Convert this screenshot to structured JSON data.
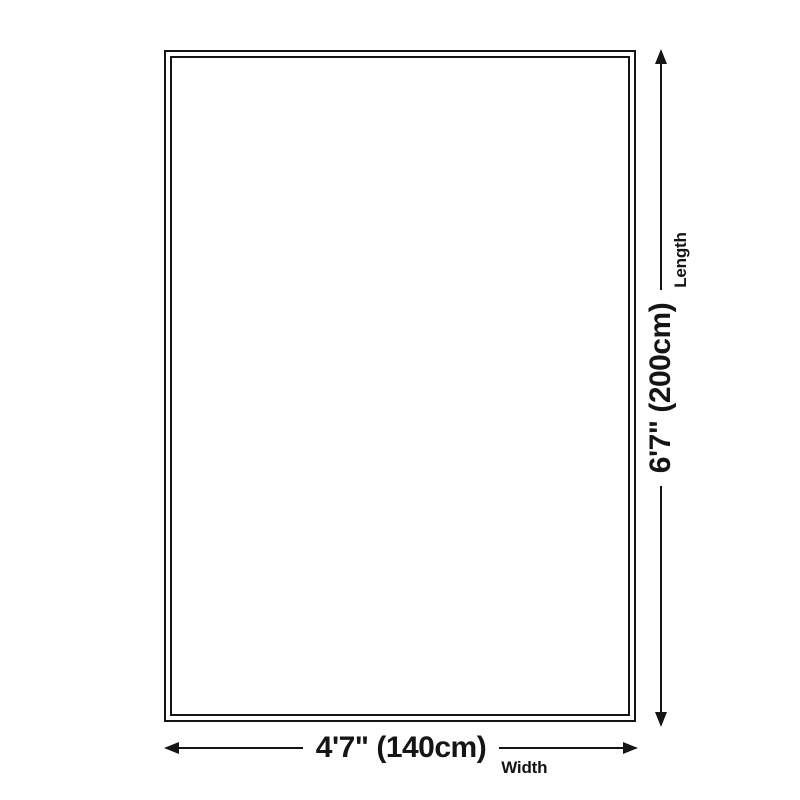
{
  "diagram": {
    "type": "product-size-diagram",
    "dimensions": {
      "width": {
        "value": "4'7\" (140cm)",
        "label": "Width"
      },
      "length": {
        "value": "6'7\" (200cm)",
        "label": "Length"
      }
    },
    "colors": {
      "line": "#151515",
      "text": "#151515",
      "background": "#ffffff"
    }
  }
}
